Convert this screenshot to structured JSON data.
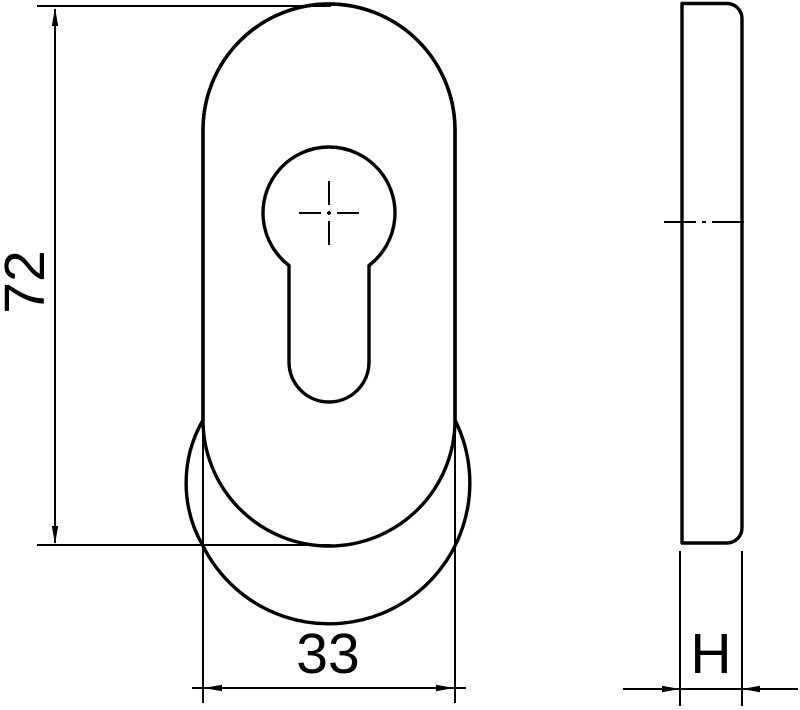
{
  "page": {
    "background_color": "#ffffff",
    "line_color": "#000000",
    "description": "Technical drawing of an oval escutcheon plate with euro profile cylinder keyhole, front view and side thickness view"
  },
  "views": {
    "front": {
      "name": "front-view-oval-plate-with-keyhole",
      "dim_height": "72",
      "dim_width": "33"
    },
    "side": {
      "name": "side-view-thickness-profile",
      "dim_thickness": "H"
    }
  }
}
